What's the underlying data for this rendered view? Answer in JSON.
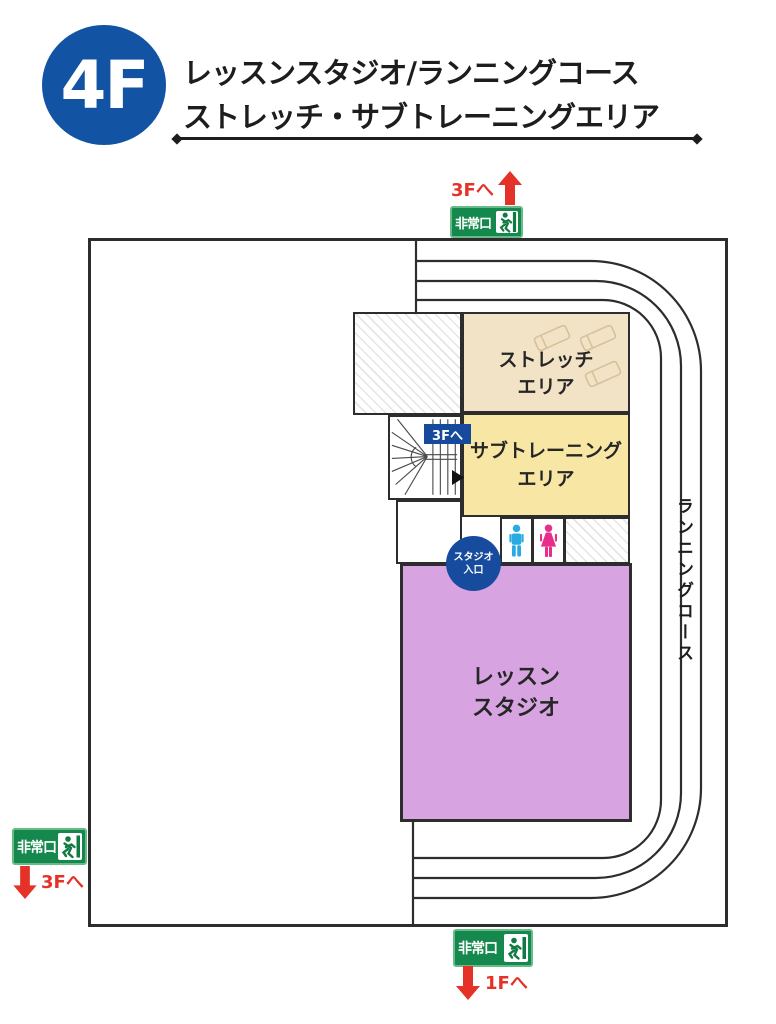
{
  "header": {
    "floor_label": "4F",
    "title_line1": "レッスンスタジオ/ランニングコース",
    "title_line2": "ストレッチ・サブトレーニングエリア"
  },
  "plan": {
    "running_course": {
      "label": "ランニングコース"
    },
    "stairs": {
      "to_floor_badge": "3Fへ"
    },
    "areas": {
      "stretch": {
        "label_line1": "ストレッチ",
        "label_line2": "エリア",
        "color": "#f2e3c6"
      },
      "sub_training": {
        "label_line1": "サブトレーニング",
        "label_line2": "エリア",
        "color": "#f8e7a4"
      },
      "lesson_studio": {
        "label_line1": "レッスン",
        "label_line2": "スタジオ",
        "color": "#d7a4e1"
      }
    },
    "studio_entrance": {
      "label_line1": "スタジオ",
      "label_line2": "入口",
      "color": "#174b9d"
    }
  },
  "exits": {
    "top": {
      "sign_label": "非常口",
      "direction_label": "3Fへ"
    },
    "bottom_left": {
      "sign_label": "非常口",
      "direction_label": "3Fへ"
    },
    "bottom_center": {
      "sign_label": "非常口",
      "direction_label": "1Fへ"
    }
  },
  "colors": {
    "wall": "#2d2d2d",
    "header_blue": "#1253a4",
    "badge_blue": "#164a9c",
    "sign_green": "#15894d",
    "sign_border_green": "#68bb86",
    "arrow_red": "#e53228",
    "male_blue": "#29abe2",
    "female_pink": "#e62e8a"
  }
}
